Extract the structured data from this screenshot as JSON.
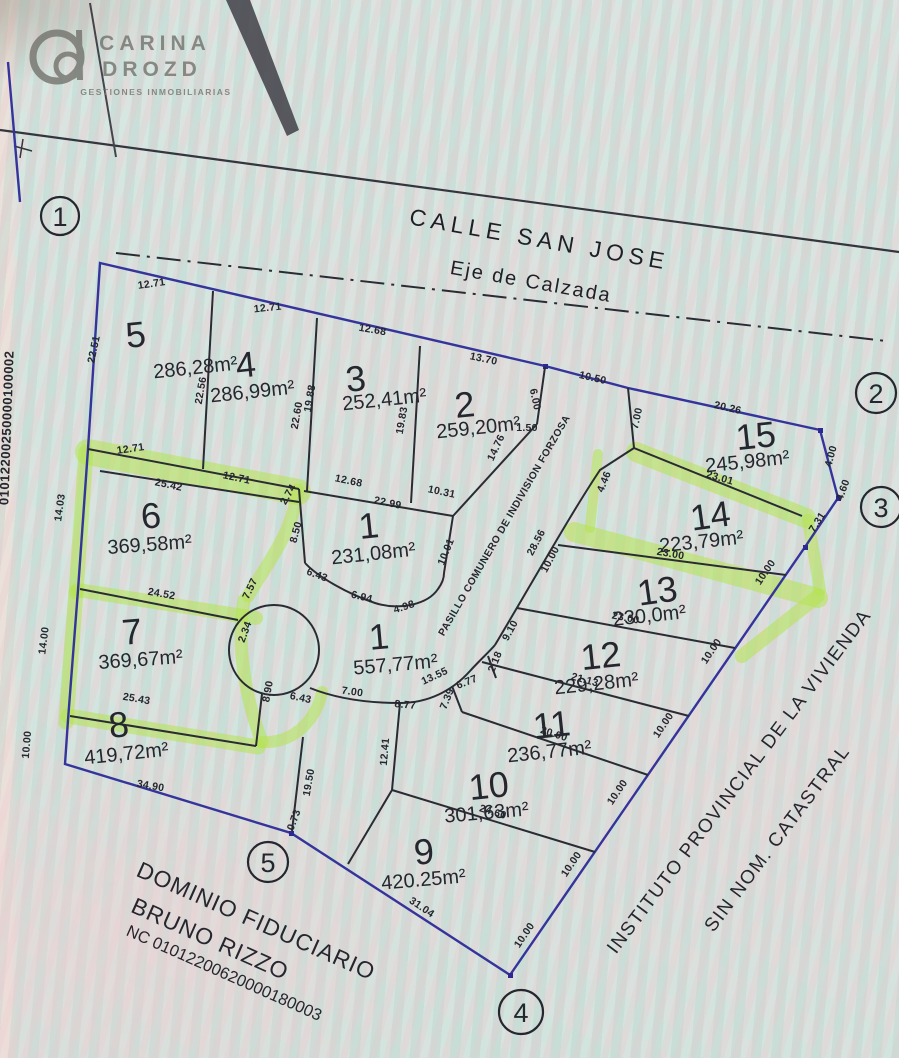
{
  "watermark": {
    "brand_line1": "CARINA",
    "brand_line2": "DROZD",
    "tagline": "GESTIONES INMOBILIARIAS"
  },
  "street": {
    "name": "CALLE SAN JOSE",
    "axis_label": "Eje de Calzada"
  },
  "corridor_label": "PASILLO COMUNERO DE INDIVISION FORZOSA",
  "neighbor": {
    "line1": "INSTITUTO PROVINCIAL DE LA VIVIENDA",
    "line2": "SIN NOM. CATASTRAL"
  },
  "fiduciary": {
    "line1": "DOMINIO FIDUCIARIO",
    "line2": "BRUNO RIZZO",
    "nc": "NC 01012200620000180003"
  },
  "left_margin_nc": "01012200250000100002",
  "vertices": [
    "1",
    "2",
    "3",
    "4",
    "5"
  ],
  "lots": [
    {
      "number": "5",
      "area": "286,28m²"
    },
    {
      "number": "4",
      "area": "286,99m²"
    },
    {
      "number": "3",
      "area": "252,41m²"
    },
    {
      "number": "2",
      "area": "259,20m²"
    },
    {
      "number": "15",
      "area": "245,98m²"
    },
    {
      "number": "14",
      "area": "223,79m²"
    },
    {
      "number": "13",
      "area": "230,0m²"
    },
    {
      "number": "12",
      "area": "229,28m²"
    },
    {
      "number": "11",
      "area": "236,77m²"
    },
    {
      "number": "10",
      "area": "301,63m²"
    },
    {
      "number": "9",
      "area": "420.25m²"
    },
    {
      "number": "8",
      "area": "419,72m²"
    },
    {
      "number": "7",
      "area": "369,67m²"
    },
    {
      "number": "6",
      "area": "369,58m²"
    },
    {
      "number": "1",
      "area": "231,08m²"
    },
    {
      "number": "1",
      "area": "557,77m²"
    }
  ],
  "measurements": [
    "12.71",
    "12.71",
    "12.68",
    "13.70",
    "6.00",
    "10.50",
    "7.00",
    "20.26",
    "4.00",
    "4.60",
    "22.51",
    "22.56",
    "22.60",
    "19.88",
    "19.83",
    "14.76",
    "1.50",
    "12.71",
    "25.42",
    "12.71",
    "2.74",
    "14.03",
    "12.68",
    "22.99",
    "10.31",
    "10.01",
    "8.50",
    "6.43",
    "6.94",
    "4.98",
    "24.52",
    "7.57",
    "14.00",
    "2.34",
    "8.90",
    "25.43",
    "6.43",
    "7.00",
    "8.77",
    "13.55",
    "6.77",
    "7.39",
    "2.18",
    "9.10",
    "28.56",
    "10.00",
    "4.46",
    "23.01",
    "7.31",
    "23.00",
    "10.00",
    "23.00",
    "10.00",
    "21.13",
    "10.00",
    "20.00",
    "10.00",
    "12.41",
    "19.50",
    "24.60",
    "10.00",
    "31.04",
    "10.00",
    "34.90",
    "10.00",
    "0.73"
  ],
  "colors": {
    "highlighter": "#b5e44e",
    "boundary_line": "#34349b",
    "lot_line": "#2b2b33",
    "background": "#d4e4df"
  }
}
